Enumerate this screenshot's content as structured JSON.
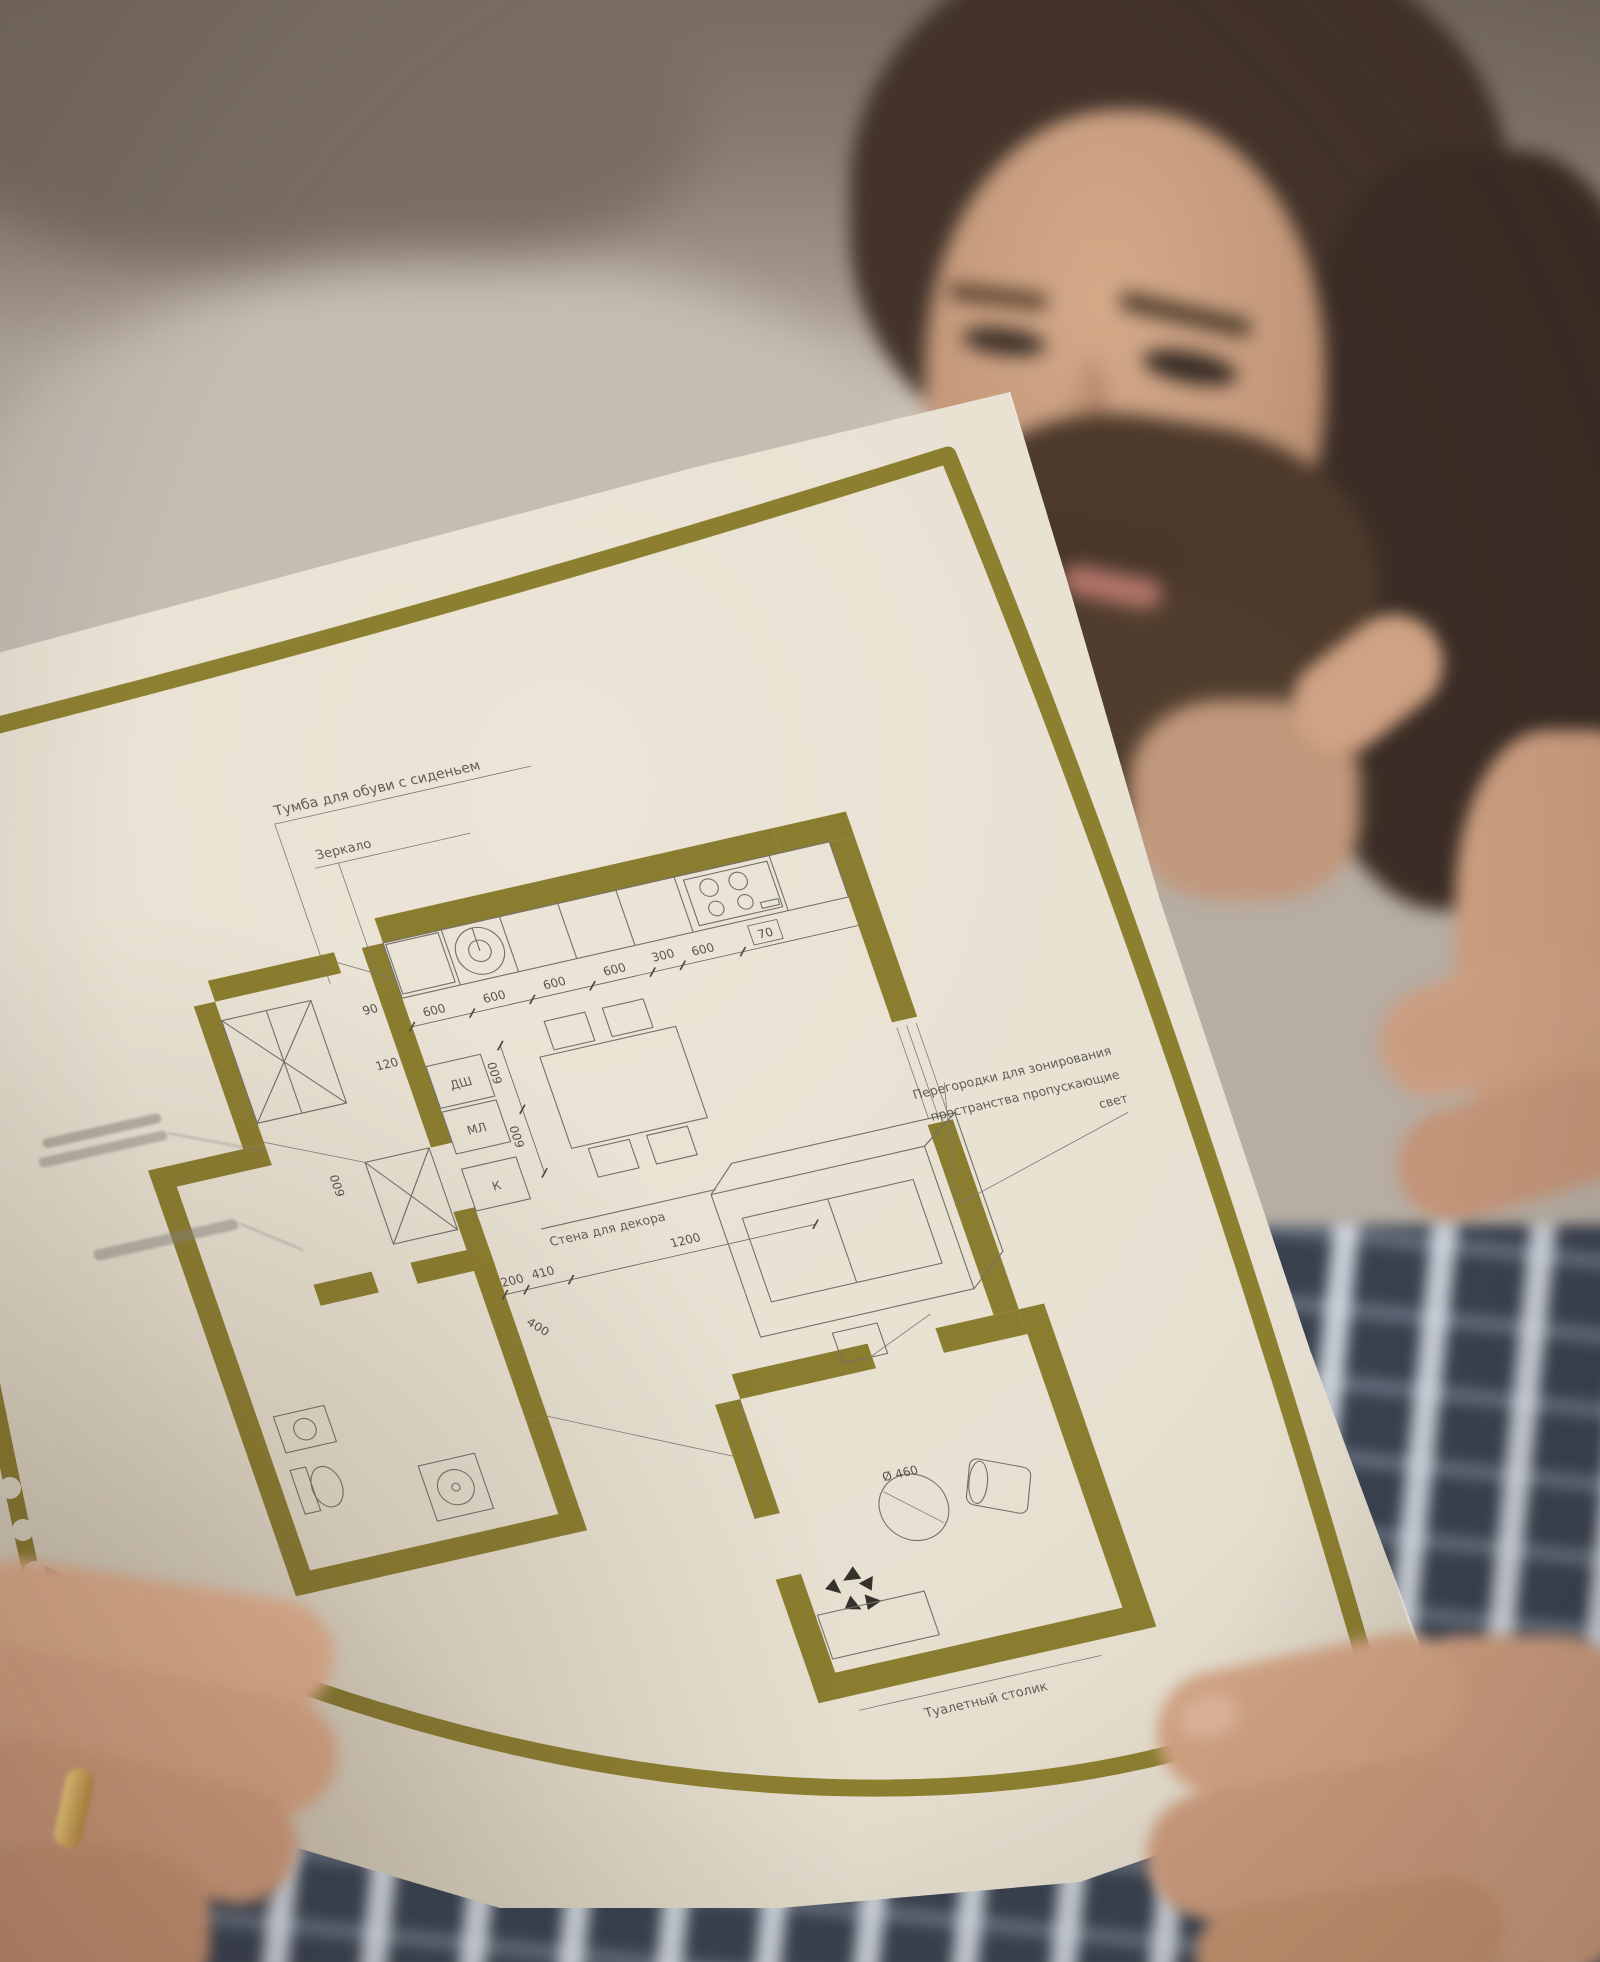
{
  "photo": {
    "subject": "man reading a rolled architectural floor-plan printout",
    "palette": {
      "accent_olive": "#8b7d2f",
      "paper": "#e7e0d1",
      "wall_bg": "#b7ada3",
      "skin": "#cb9d80",
      "hair": "#43332a",
      "shirt_plaid": "#39414f",
      "ring_gold": "#d4ab5e"
    }
  },
  "plan": {
    "labels": {
      "shoe_cabinet": "Тумба для обуви с сиденьем",
      "mirror": "Зеркало",
      "partitions_line1": "Перегородки для зонирования",
      "partitions_line2": "пространства пропускающие",
      "partitions_line3": "свет",
      "decor_wall": "Стена для декора",
      "vanity": "Туалетный столик",
      "dishwasher": "ДШ",
      "washer": "МЛ",
      "k": "К"
    },
    "dims": {
      "counter": [
        "600",
        "600",
        "600",
        "600",
        "300",
        "600"
      ],
      "counter_end": "70",
      "wall_offset": "120",
      "wall_offset2": "90",
      "island": [
        "600",
        "600"
      ],
      "mid_chain": [
        "200",
        "410",
        "1200"
      ],
      "diagonal": "400",
      "left_vertical": "600",
      "pouf": "Ø 460"
    }
  }
}
